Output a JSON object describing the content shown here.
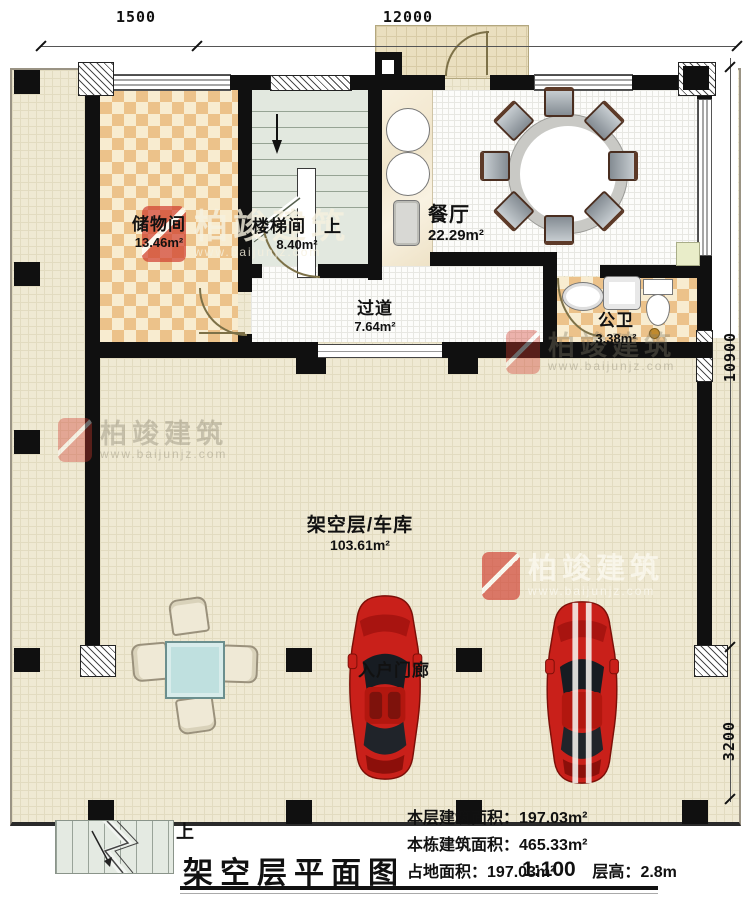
{
  "dimensions": {
    "top_left": "1500",
    "top_span": "12000",
    "right_span": "10900",
    "right_porch": "3200"
  },
  "rooms": [
    {
      "name": "储物间",
      "area": "13.46m²"
    },
    {
      "name": "楼梯间",
      "area": "8.40m²",
      "direction": "上"
    },
    {
      "name": "餐厅",
      "area": "22.29m²"
    },
    {
      "name": "过道",
      "area": "7.64m²"
    },
    {
      "name": "公卫",
      "area": "3.38m²"
    },
    {
      "name": "架空层/车库",
      "area": "103.61m²"
    },
    {
      "name": "入户门廊"
    }
  ],
  "exterior_stairs": {
    "up_label": "上"
  },
  "title_block": {
    "title": "架空层平面图",
    "scale": "1:100",
    "stats": [
      {
        "label": "本层建筑面积：",
        "value": "197.03m²"
      },
      {
        "label": "本栋建筑面积：",
        "value": "465.33m²"
      },
      {
        "label": "占地面积：",
        "value": "197.03m²"
      },
      {
        "label": "层高：",
        "value": "2.8m"
      }
    ]
  },
  "watermark": {
    "brand": "柏竣建筑",
    "url": "www.baijunjz.com"
  },
  "colors": {
    "car_red": "#c9201a",
    "wall": "#101010",
    "patio_tile": "#efe9d3",
    "checker_dark": "#ecc28a",
    "checker_light": "#f8ecd0",
    "table_blue": "#bfe0df",
    "stair_green": "#e2e8df",
    "watermark_red": "#d0382a"
  }
}
